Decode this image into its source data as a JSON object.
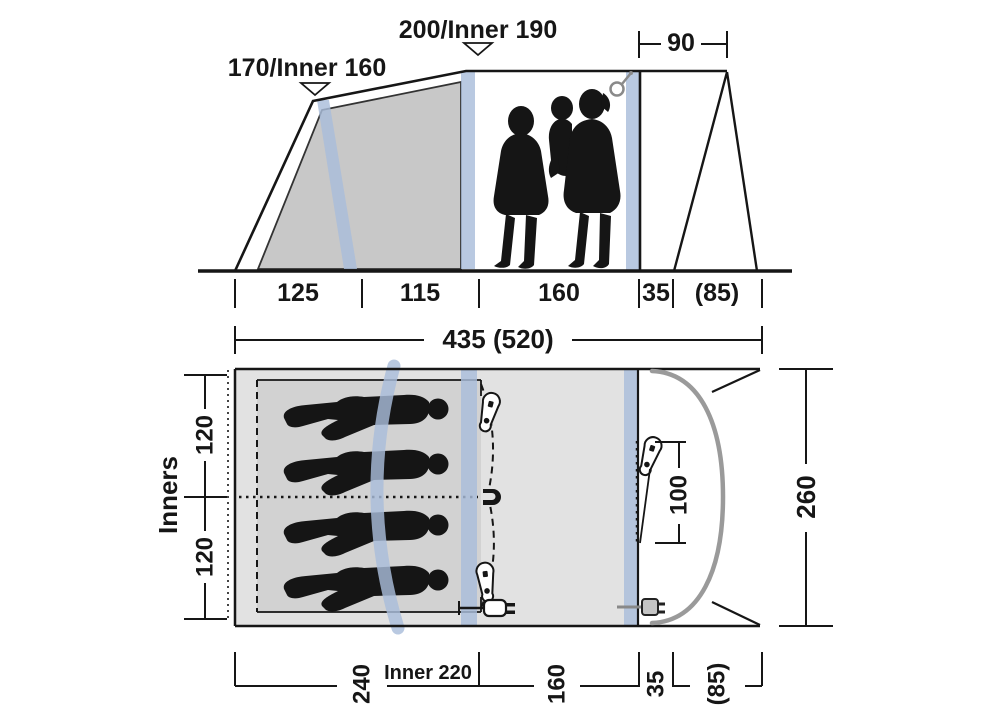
{
  "diagram": {
    "side_view": {
      "peak_left_label": "170/Inner 160",
      "peak_right_label": "200/Inner 190",
      "canopy_depth": "90",
      "base_segments": [
        "125",
        "115",
        "160",
        "35",
        "(85)"
      ],
      "total_length": "435 (520)"
    },
    "floor_plan": {
      "inners_label": "Inners",
      "inner_cabin_widths": [
        "120",
        "120"
      ],
      "door_width": "100",
      "tent_width": "260",
      "inner_depth_label": "Inner 220",
      "depth_segments": [
        "240",
        "160",
        "35",
        "(85)"
      ]
    },
    "colors": {
      "pole_blue": "#a9bdda",
      "floor_gray": "#e2e2e2",
      "inner_floor_gray": "#d2d2d2",
      "cabin_gray": "#c8c8c8",
      "canopy_gray": "#9a9a9a",
      "line_black": "#161616"
    }
  }
}
